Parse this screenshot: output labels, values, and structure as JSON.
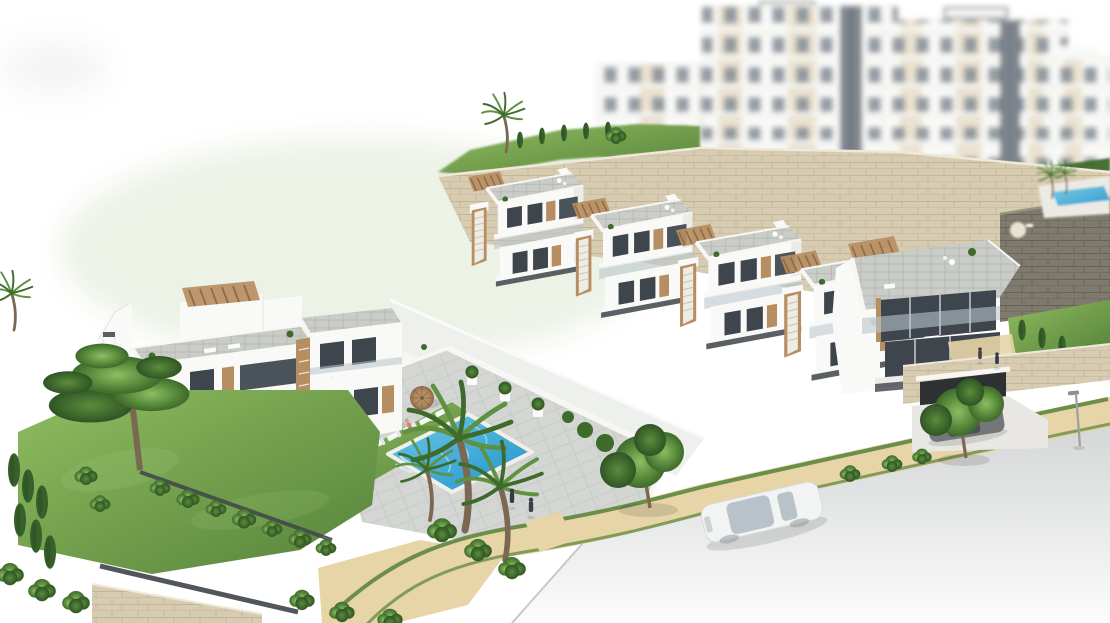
{
  "scene": {
    "title": "Aerial 3D architectural render of a hillside residential development with villas, townhouses, apartment blocks, gardens, a swimming pool and a street",
    "setting": "daytime render on white background"
  },
  "objects": {
    "apartments": "Blurred white apartment blocks in background",
    "hillside": "Landscaped hillside with palm and cypress trees",
    "rooftop_pool": "Small upper-terrace pool",
    "retaining_wall": "Beige stone retaining wall",
    "dark_wall": "Dark stone retaining wall",
    "townhouses": "Row of white townhouses with wooden roof pergolas and exterior stairs",
    "corner_villa": "Angular white corner villa with roof terrace",
    "left_villa": "Two-storey white villa with roof terrace and pergola",
    "pool_area": "Communal terrace with swimming pool, sun loungers and parasols",
    "pool": "Blue swimming pool",
    "lawn": "Sunbathing lawn with white loungers",
    "parasols": "Two brown straw parasols",
    "garden": "Front garden with pine, palms, hedges and fence",
    "road": "Curved light-grey street",
    "path": "Sand-coloured walkway with green verges",
    "white_car": "White car driving on the street",
    "dark_car": "Grey car parked on the driveway",
    "garage": "Garage entrance in stone-clad wall",
    "street_lamp": "Street lamp",
    "pedestrians": "Small pedestrian figures",
    "sidewalk_trees": "Olive trees along the walkway"
  },
  "colors": {
    "bg": "#ffffff",
    "haze-green": "#e8efe1",
    "bldg-white": "#f9f9f7",
    "bldg-shade": "#ebebe7",
    "beige-panel": "#ddcbaa",
    "window-dark": "#3e454c",
    "window-mid": "#848d96",
    "glass-light": "#b9c6cc",
    "wood": "#b78e62",
    "wood-dark": "#8f6c46",
    "paver": "#c9ccc7",
    "paver-line": "#b3b6b1",
    "terrace": "#d3d6d3",
    "terrace-line": "#c5c8c5",
    "stone-light": "#d7ccb2",
    "stone-line": "#c3b697",
    "stone-dark": "#7e7a6d",
    "stone-dark-line": "#666256",
    "lawn": "#7cab4e",
    "lawn-light": "#90bc60",
    "lawn-dark": "#55823a",
    "tree-green": "#5f9140",
    "tree-dark": "#3e6a2b",
    "cypress": "#37612a",
    "pool-light": "#6ec9e9",
    "pool-deep": "#1f93c9",
    "sand": "#e7d5a7",
    "sand-edge": "#d2bc8b",
    "road": "#d4d6d7",
    "road-fade": "#fcfcfc",
    "curb": "#c6c9ca",
    "fence": "#3e4449",
    "parapet": "#f7f6f3",
    "car-white": "#f2f4f4",
    "car-dark": "#73777a",
    "trunk": "#7a6852"
  }
}
